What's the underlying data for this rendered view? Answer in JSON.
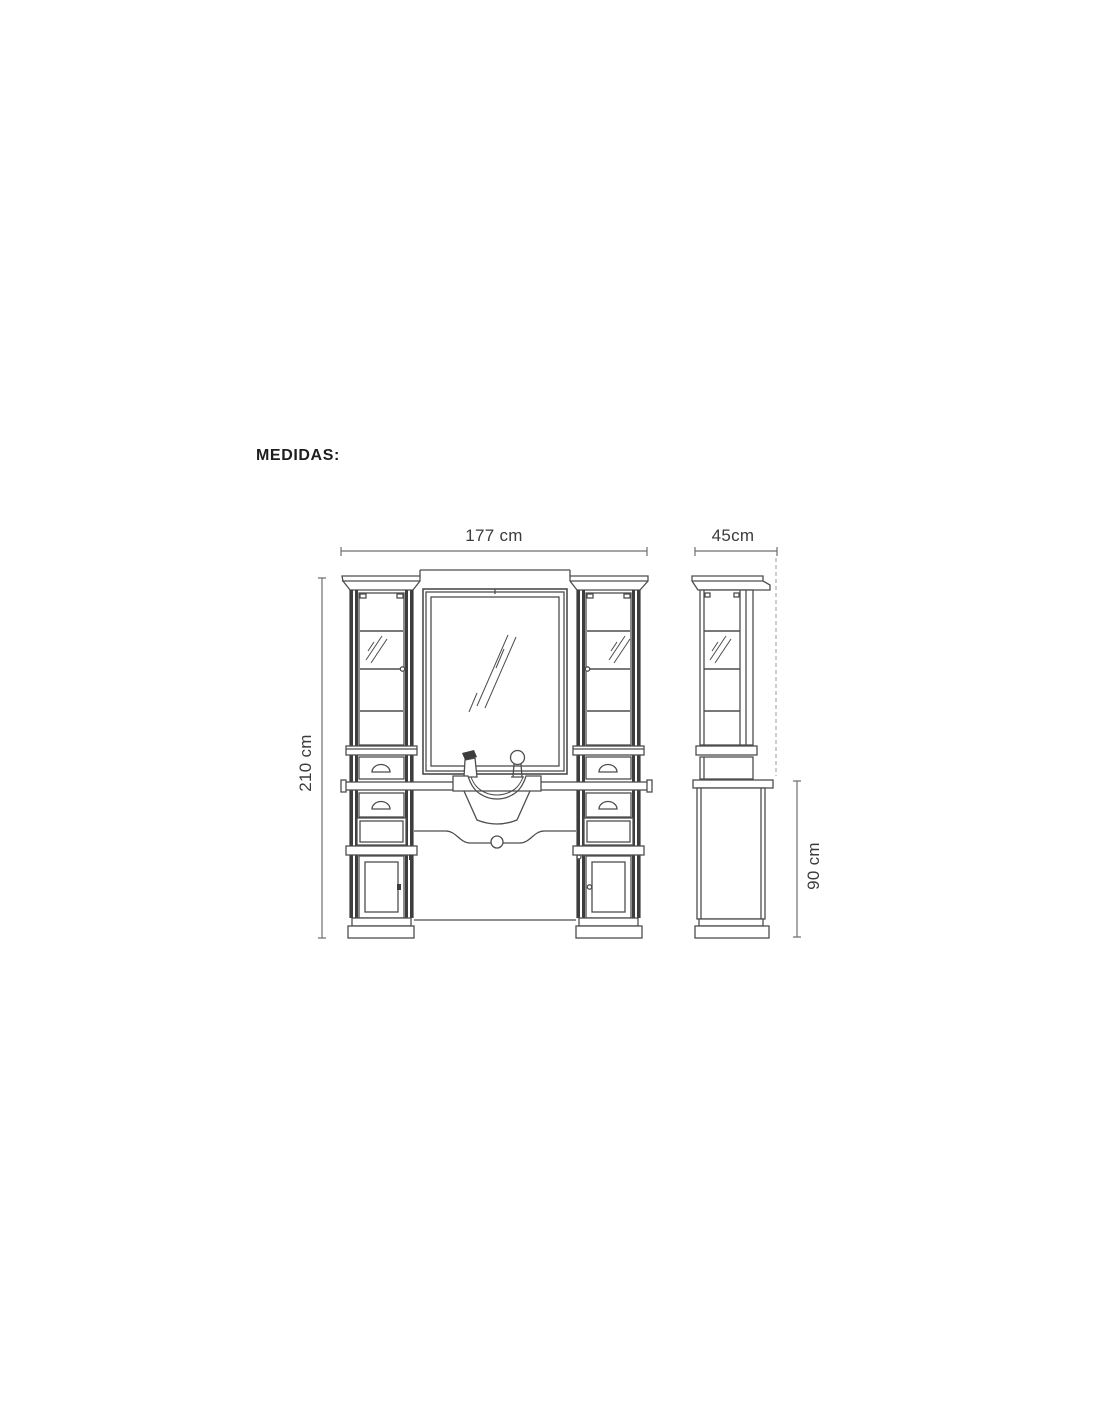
{
  "section": {
    "title": "MEDIDAS:"
  },
  "dimensions": {
    "front_width": {
      "label": "177 cm",
      "value_cm": 177
    },
    "side_depth": {
      "label": "45cm",
      "value_cm": 45
    },
    "total_height": {
      "label": "210 cm",
      "value_cm": 210
    },
    "counter_height": {
      "label": "90 cm",
      "value_cm": 90
    }
  },
  "drawing": {
    "description": "Salon mirror station technical drawing: front elevation with two glass display towers, central mirror and washbasin, plus side elevation",
    "views": [
      "front-elevation",
      "side-elevation"
    ],
    "colors": {
      "background": "#ffffff",
      "line": "#4d4d4d",
      "dark_fill": "#3d3d3d",
      "dimension_line": "#6f6f6f",
      "dashed_reference": "#9a9a9a",
      "text": "#3b3b3b"
    }
  }
}
